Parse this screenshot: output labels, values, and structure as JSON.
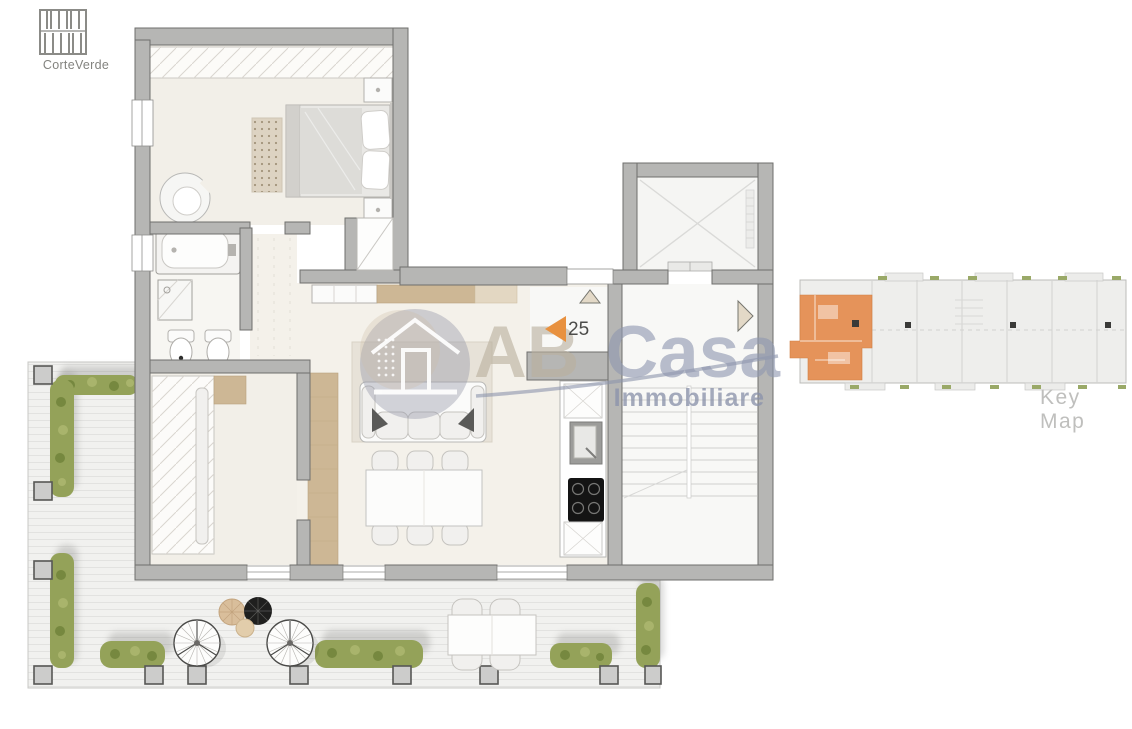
{
  "branding": {
    "logo_label": "CorteVerde",
    "logo_icon": "building-facade-icon"
  },
  "watermark": {
    "brand_first": "AB",
    "brand_second": "Casa",
    "subtitle": "Immobiliare",
    "icon": "house-in-circle-icon"
  },
  "unit_marker": {
    "number": "25",
    "icon": "entry-arrow-icon"
  },
  "key_map": {
    "label": "Key Map"
  },
  "colors": {
    "marker_orange": "#E8913F",
    "unit_orange": "#E5935A",
    "wall_gray": "#B6B6B4",
    "hedge_green": "#94A259",
    "wood": "#CDB795",
    "watermark_blue": "#8F97B0",
    "watermark_beige": "#BAB09E",
    "keymap_text": "#BFBFBD",
    "logo_text": "#83837F"
  }
}
